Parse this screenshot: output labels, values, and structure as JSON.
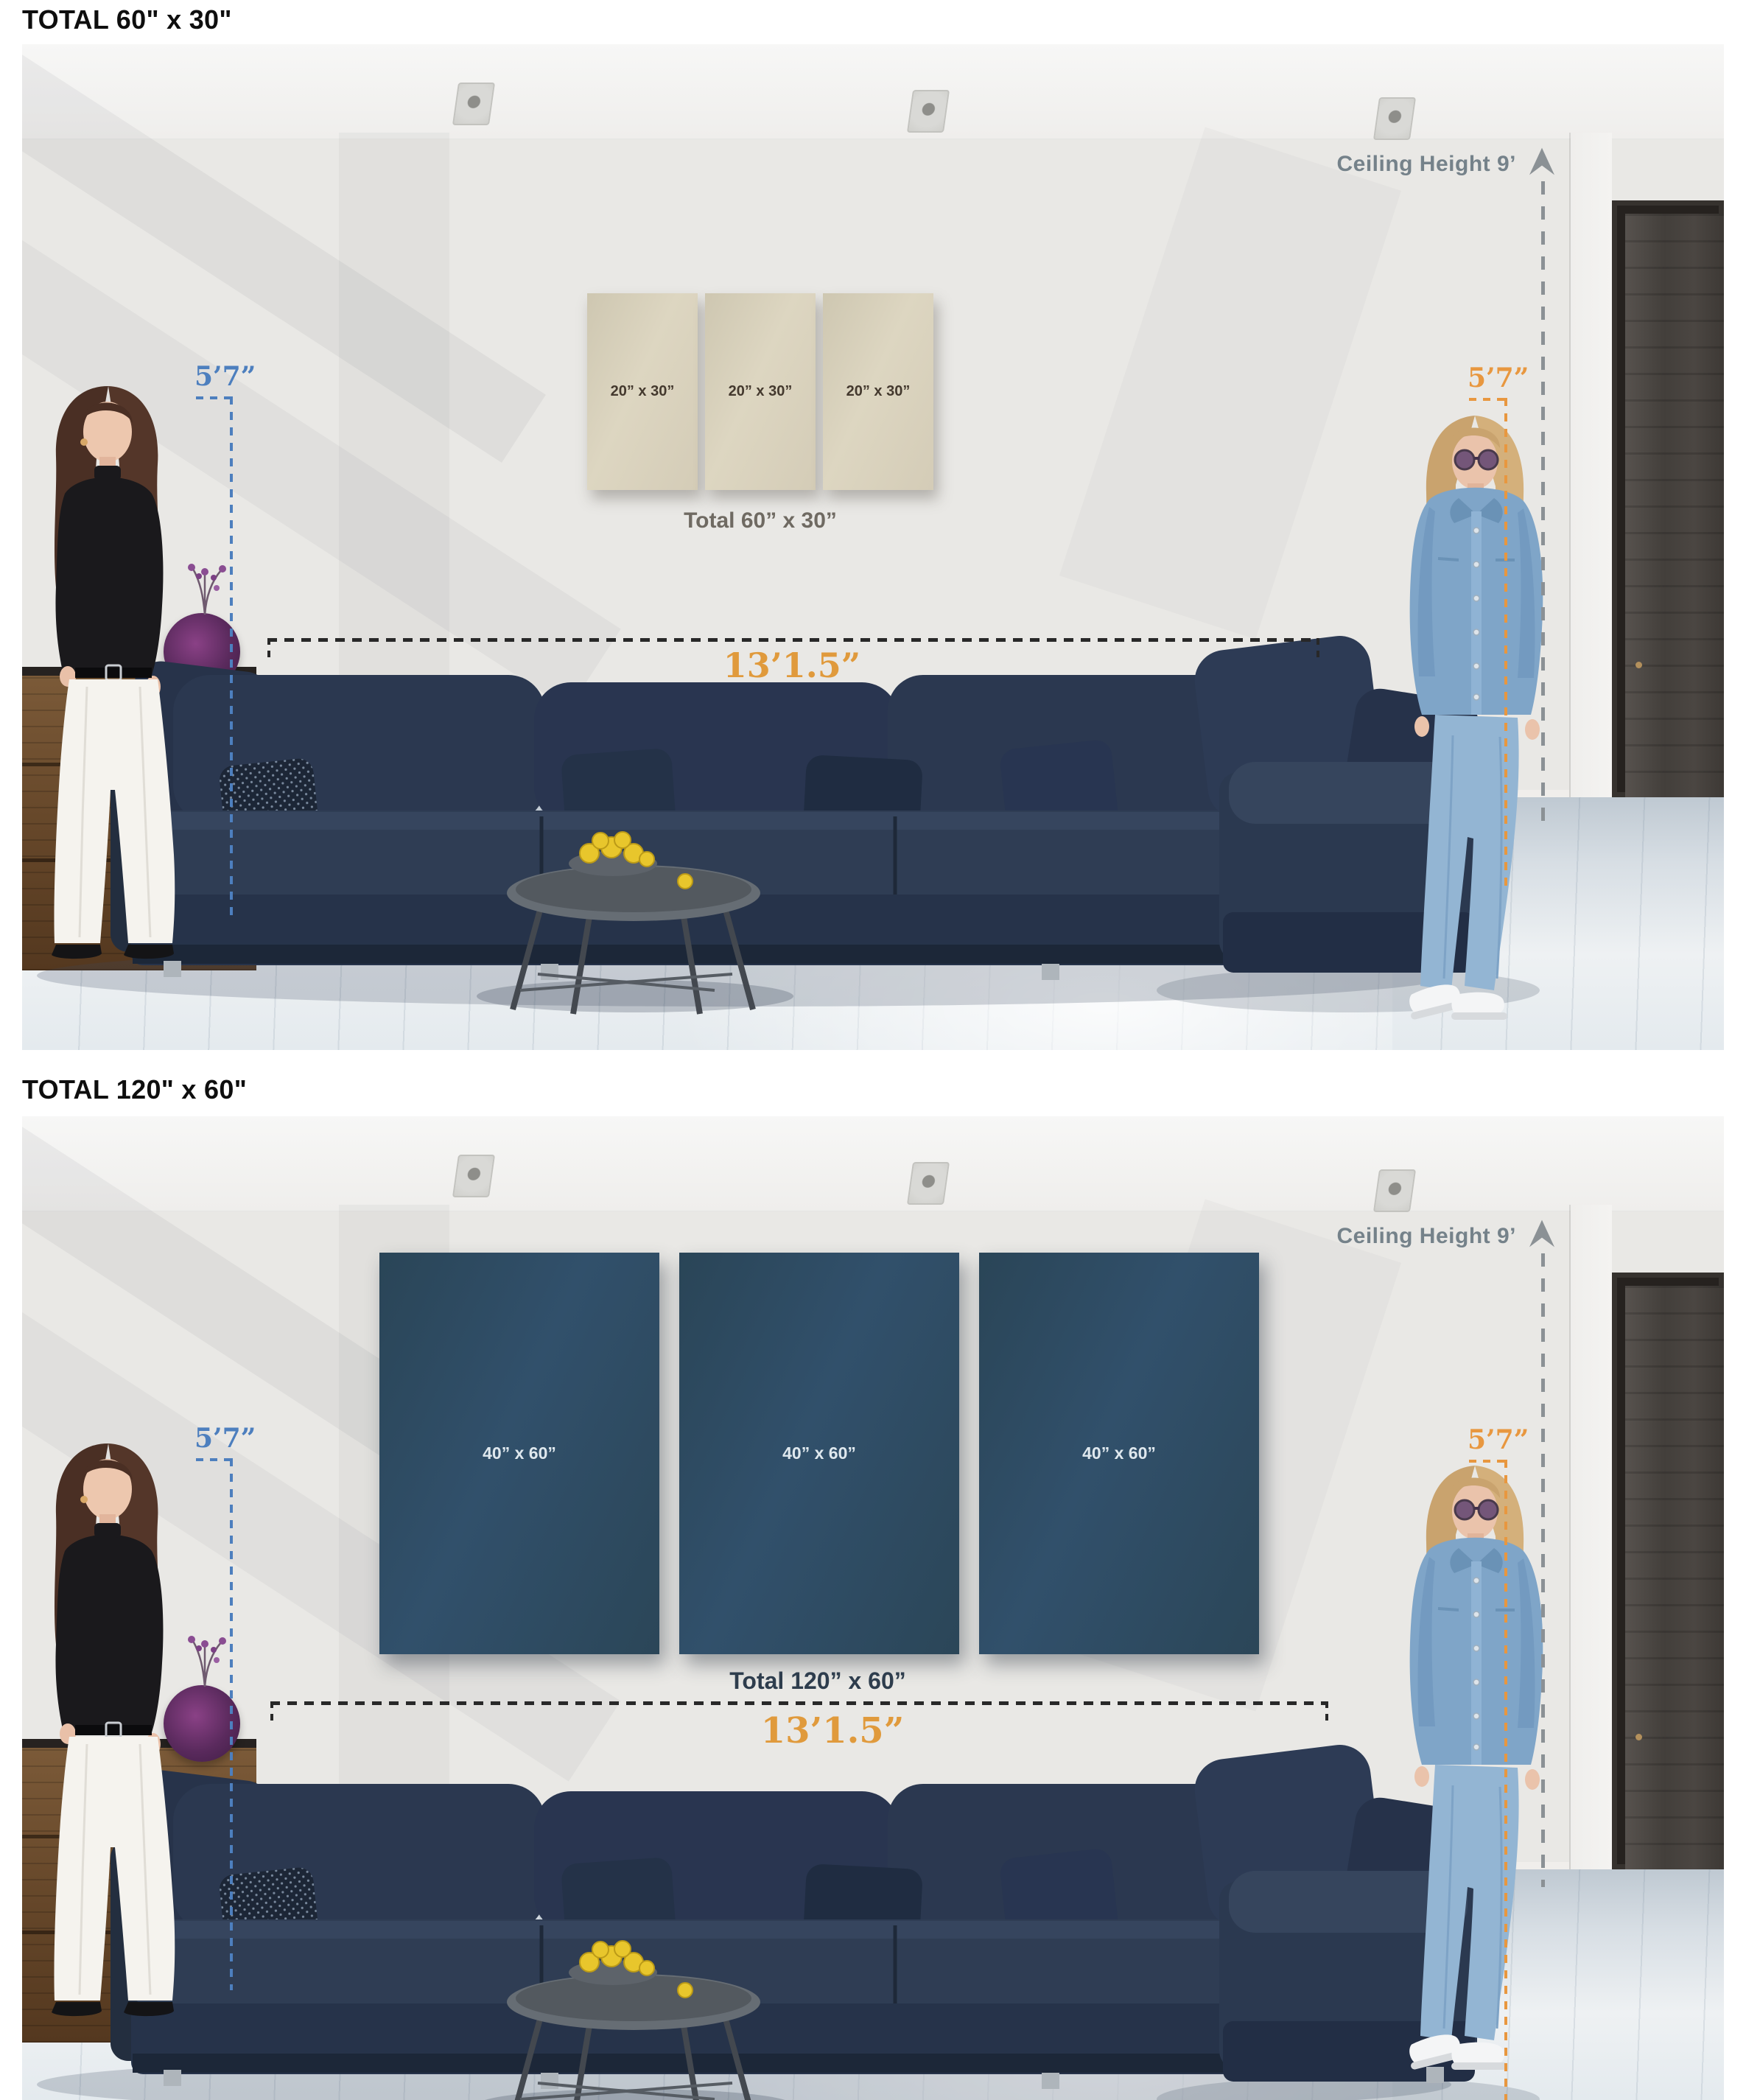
{
  "sections": [
    {
      "heading": "TOTAL 60\" x 30\"",
      "panel_labels": [
        "20” x 30”",
        "20” x 30”",
        "20” x 30”"
      ],
      "total_label": "Total 60” x 30”",
      "panel_color": "#d8d1bc",
      "panel_text_color": "#44392e",
      "total_label_color": "#6f6a62"
    },
    {
      "heading": "TOTAL 120\" x 60\"",
      "panel_labels": [
        "40” x 60”",
        "40” x 60”",
        "40” x 60”"
      ],
      "total_label": "Total 120” x 60”",
      "panel_color": "#2e4a5d",
      "panel_text_color": "#dfe8ee",
      "total_label_color": "#2e3d4d"
    }
  ],
  "annotations": {
    "ceiling_height_label": "Ceiling Height 9’",
    "person_height_left": "5’7”",
    "person_height_right": "5’7”",
    "sofa_width_label": "13’1.5”",
    "colors": {
      "ceiling_text": "#75828a",
      "height_left_blue": "#4d7fbe",
      "height_right_orange": "#e8973f",
      "sofa_width_orange": "#e09a3c",
      "dimension_dash": "#282828"
    }
  }
}
